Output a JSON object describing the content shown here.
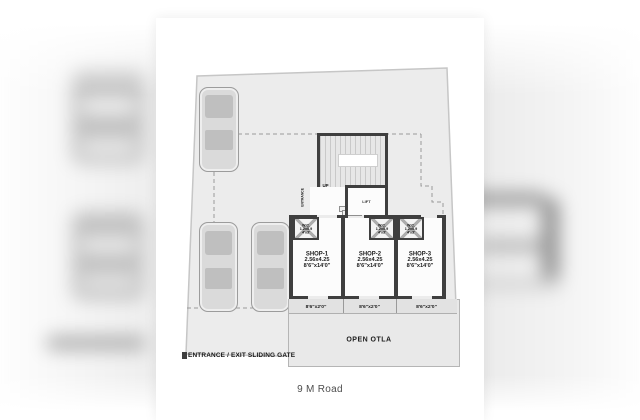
{
  "page": {
    "road_label": "9 M Road"
  },
  "plan": {
    "gate_label": "ENTRANCE / EXIT SLIDING GATE",
    "open_otla_label": "OPEN OTLA",
    "up_label": "UP",
    "lift_label": "LIFT",
    "entrance_label": "ENTRANCE",
    "wc": {
      "label": "W.C.",
      "size_m": "1.2x0.9",
      "size_ft": "4'x3'"
    },
    "shops": [
      {
        "name": "SHOP-1",
        "size_m": "2.56x4.25",
        "size_ft": "8'6\"x14'0\"",
        "otla_size": "8'6\"x2'0\""
      },
      {
        "name": "SHOP-2",
        "size_m": "2.56x4.25",
        "size_ft": "8'6\"x14'0\"",
        "otla_size": "8'6\"x2'0\""
      },
      {
        "name": "SHOP-3",
        "size_m": "2.56x4.25",
        "size_ft": "8'6\"x14'0\"",
        "otla_size": "8'6\"x2'0\""
      }
    ],
    "colors": {
      "wall": "#3f3f3f",
      "plot_fill": "#ececec",
      "platform_fill": "#e9e9e9",
      "car_fill": "#dadada"
    }
  }
}
